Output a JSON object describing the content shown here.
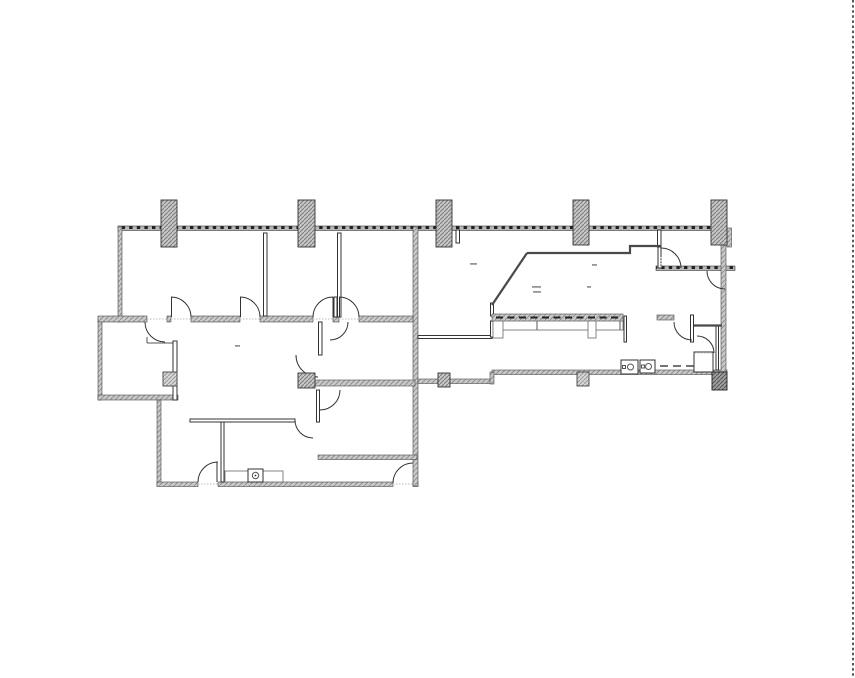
{
  "floor_plan": {
    "type": "architectural-floor-plan",
    "title_note": "office suite floor plan line drawing, no legible text labels",
    "colors": {
      "wall_line": "#333333",
      "hatch_base": "#c9c9c9",
      "hatch_line": "#8f8f8f",
      "tick_dark": "#1f1f1f",
      "label_mark": "#979797",
      "page_edge": "#111111"
    },
    "columns": {
      "top_row": [
        {
          "x": 161,
          "y": 200,
          "w": 16,
          "h": 47
        },
        {
          "x": 298,
          "y": 200,
          "w": 17,
          "h": 47
        },
        {
          "x": 436,
          "y": 200,
          "w": 16,
          "h": 47
        },
        {
          "x": 573,
          "y": 200,
          "w": 16,
          "h": 45
        },
        {
          "x": 711,
          "y": 200,
          "w": 16,
          "h": 45
        }
      ],
      "interior": [
        {
          "x": 163,
          "y": 372,
          "w": 14,
          "h": 14,
          "shade": "light"
        },
        {
          "x": 298,
          "y": 373,
          "w": 17,
          "h": 15,
          "shade": "normal"
        },
        {
          "x": 438,
          "y": 373,
          "w": 12,
          "h": 14,
          "shade": "normal"
        },
        {
          "x": 577,
          "y": 372,
          "w": 12,
          "h": 14,
          "shade": "light"
        },
        {
          "x": 712,
          "y": 372,
          "w": 15,
          "h": 18,
          "shade": "dark"
        }
      ]
    },
    "fixtures": {
      "washroom_sinks": [
        {
          "x": 621,
          "y": 360,
          "w": 17,
          "h": 14
        },
        {
          "x": 640,
          "y": 360,
          "w": 15,
          "h": 13
        }
      ],
      "washroom_dashed_line": {
        "x1": 660,
        "y": 366,
        "x2": 708
      },
      "break_counter_dashed_line": {
        "x1": 496,
        "y": 317.5,
        "x2": 620
      },
      "sink_counter_left": {
        "x": 225,
        "y": 471,
        "w": 58,
        "h": 11
      }
    },
    "label_marks": [
      {
        "x": 470,
        "y": 263,
        "w": 7
      },
      {
        "x": 592,
        "y": 264,
        "w": 5
      },
      {
        "x": 532,
        "y": 286,
        "w": 9
      },
      {
        "x": 533,
        "y": 291,
        "w": 8
      },
      {
        "x": 587,
        "y": 286,
        "w": 4
      },
      {
        "x": 235,
        "y": 345,
        "w": 5
      }
    ],
    "page_edge_line": {
      "x": 853,
      "y1": 0,
      "y2": 678,
      "style": "dotted"
    }
  }
}
